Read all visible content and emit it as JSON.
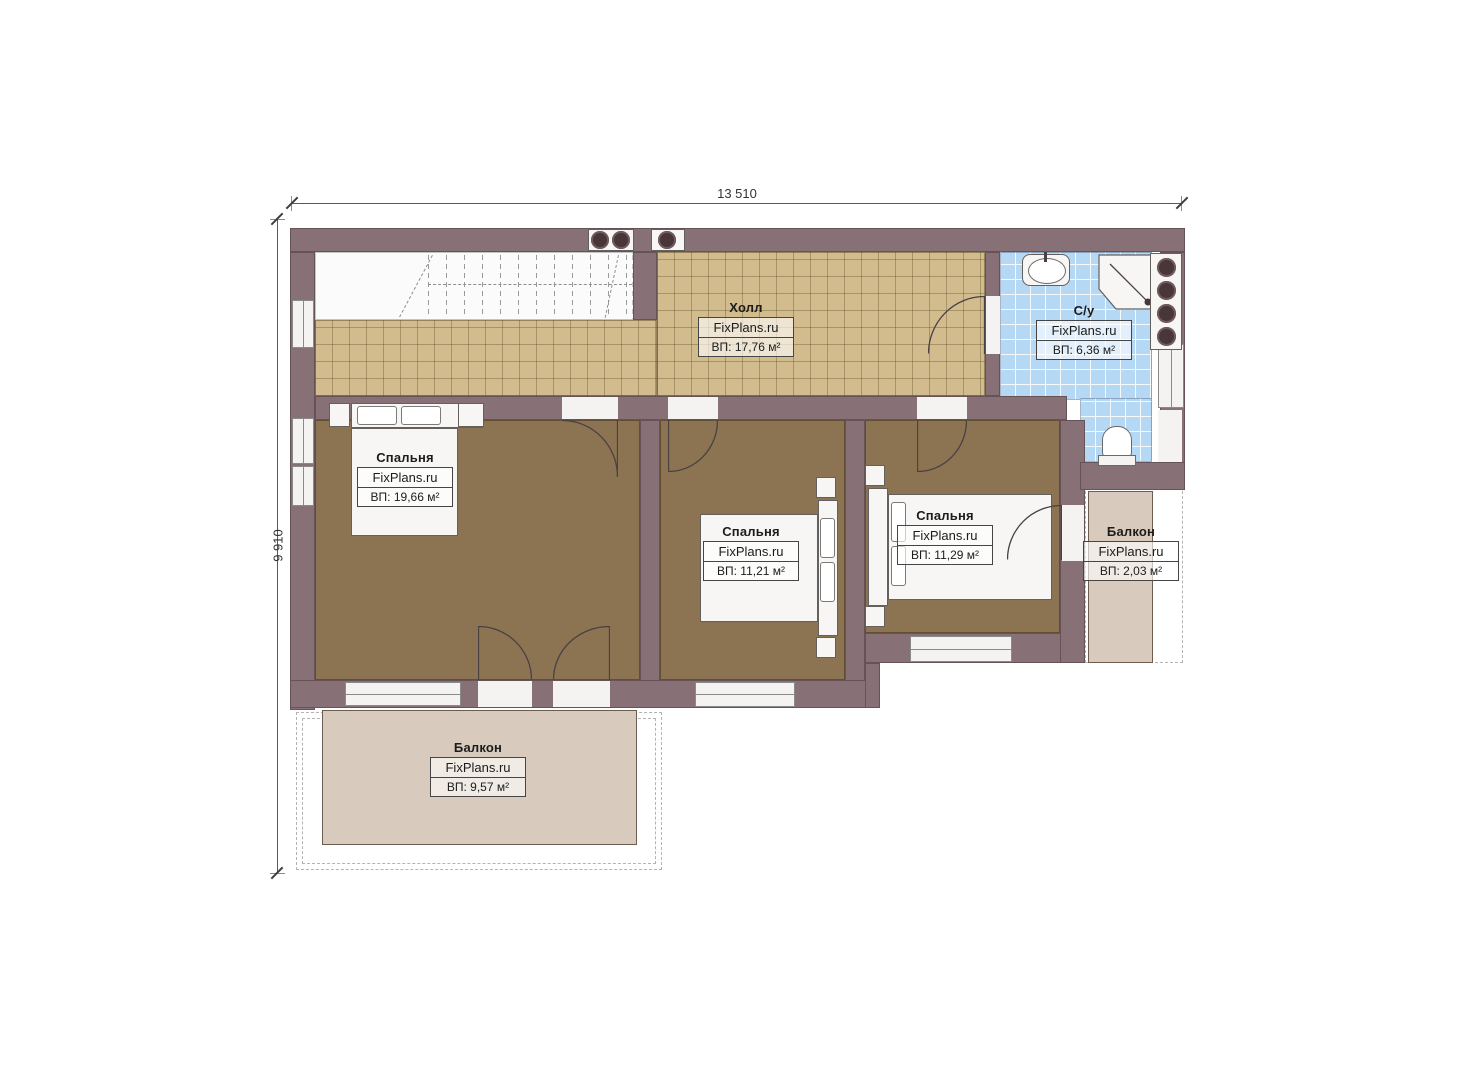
{
  "plan": {
    "type": "floor-plan",
    "brand": "FixPlans.ru",
    "dimensions": {
      "width_label": "13 510",
      "height_label": "9 910"
    },
    "palette": {
      "wall": "#877177",
      "hall_floor": "#d2bc8e",
      "bedroom_floor": "#8c7453",
      "bathroom_floor": "#b5d8f4",
      "balcony_floor": "#d8cabc"
    }
  },
  "rooms": {
    "hall": {
      "name": "Холл",
      "brand": "FixPlans.ru",
      "area": "ВП: 17,76 м²"
    },
    "bathroom": {
      "name": "С/у",
      "brand": "FixPlans.ru",
      "area": "ВП: 6,36 м²"
    },
    "bedroom_left": {
      "name": "Спальня",
      "brand": "FixPlans.ru",
      "area": "ВП: 19,66 м²"
    },
    "bedroom_middle": {
      "name": "Спальня",
      "brand": "FixPlans.ru",
      "area": "ВП: 11,21 м²"
    },
    "bedroom_right": {
      "name": "Спальня",
      "brand": "FixPlans.ru",
      "area": "ВП: 11,29 м²"
    },
    "balcony_right": {
      "name": "Балкон",
      "brand": "FixPlans.ru",
      "area": "ВП: 2,03 м²"
    },
    "balcony_bottom": {
      "name": "Балкон",
      "brand": "FixPlans.ru",
      "area": "ВП: 9,57 м²"
    }
  }
}
